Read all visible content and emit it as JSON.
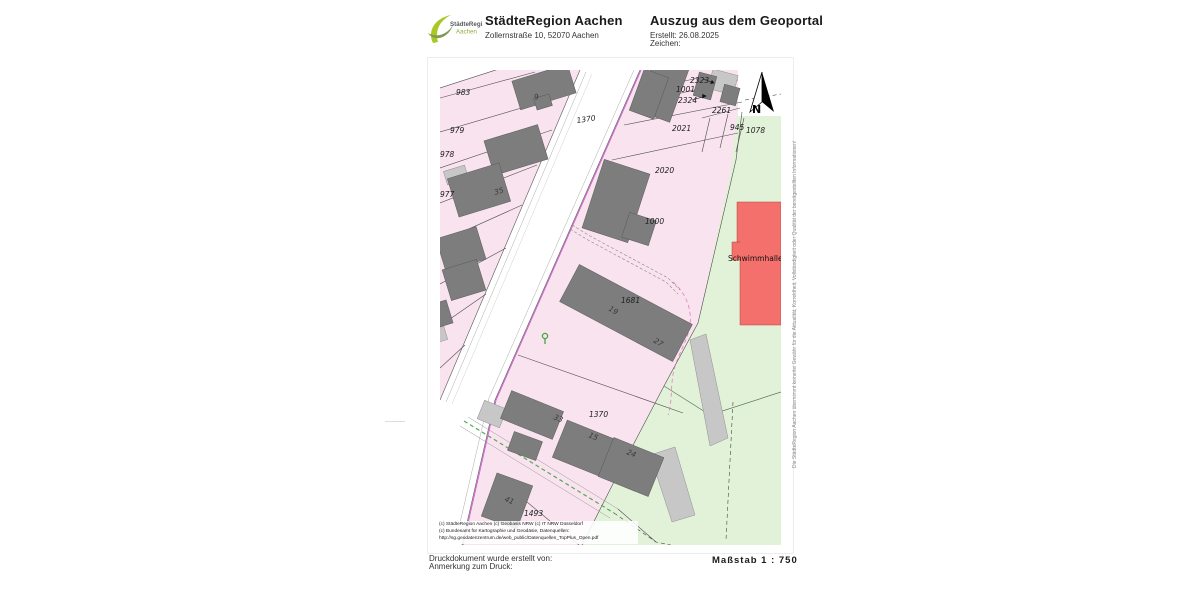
{
  "header": {
    "logo": {
      "line1": "StädteRegion",
      "line2": "Aachen"
    },
    "org_name": "StädteRegion Aachen",
    "org_address": "Zollernstraße 10, 52070 Aachen",
    "doc_title": "Auszug aus dem Geoportal",
    "created_label": "Erstellt: 26.08.2025",
    "reference_label": "Zeichen:"
  },
  "map": {
    "north_label": "N",
    "labels": [
      {
        "t": "983",
        "x": 16,
        "y": 25
      },
      {
        "t": "979",
        "x": 10,
        "y": 63
      },
      {
        "t": "978",
        "x": 0,
        "y": 87
      },
      {
        "t": "977",
        "x": 0,
        "y": 127
      },
      {
        "t": "1370",
        "x": 137,
        "y": 53,
        "r": -8
      },
      {
        "t": "2323",
        "x": 250,
        "y": 13
      },
      {
        "t": "1001",
        "x": 236,
        "y": 22
      },
      {
        "t": "2324",
        "x": 238,
        "y": 33
      },
      {
        "t": "2261",
        "x": 272,
        "y": 43
      },
      {
        "t": "2021",
        "x": 232,
        "y": 61
      },
      {
        "t": "945",
        "x": 290,
        "y": 60
      },
      {
        "t": "1078",
        "x": 306,
        "y": 63
      },
      {
        "t": "2020",
        "x": 215,
        "y": 103
      },
      {
        "t": "1000",
        "x": 205,
        "y": 154
      },
      {
        "t": "1681",
        "x": 181,
        "y": 233
      },
      {
        "t": "1370",
        "x": 149,
        "y": 347
      },
      {
        "t": "1493",
        "x": 84,
        "y": 446
      },
      {
        "t": "Schwimmhalle S",
        "x": 288,
        "y": 191,
        "k": "building",
        "s": 4.6
      },
      {
        "t": "9",
        "x": 95,
        "y": 30,
        "r": -17,
        "k": "house",
        "s": 4
      },
      {
        "t": "35",
        "x": 55,
        "y": 125,
        "r": -17,
        "k": "house",
        "s": 4
      },
      {
        "t": "19",
        "x": 168,
        "y": 240,
        "r": 31,
        "k": "house",
        "s": 4
      },
      {
        "t": "27",
        "x": 213,
        "y": 272,
        "r": 31,
        "k": "house",
        "s": 4
      },
      {
        "t": "33",
        "x": 113,
        "y": 349,
        "r": 22,
        "k": "house",
        "s": 4
      },
      {
        "t": "15",
        "x": 148,
        "y": 367,
        "r": 22,
        "k": "house",
        "s": 4
      },
      {
        "t": "24",
        "x": 186,
        "y": 384,
        "r": 22,
        "k": "house",
        "s": 4
      },
      {
        "t": "41",
        "x": 64,
        "y": 431,
        "r": 22,
        "k": "house",
        "s": 4
      }
    ],
    "copyright_lines": [
      "(c) StädteRegion Aachen   (c) Geobasis NRW   (c) IT NRW Düsseldorf",
      "(c) Bundesamt für Kartographie und Geodäsie, Datenquellen:",
      "http://sg.geodatenzentrum.de/web_public/Datenquellen_TopPlus_Open.pdf"
    ],
    "disclaimer_vertical": "Die StädteRegion Aachen übernimmt keinerlei Gewähr für die Aktualität, Korrektheit, Vollständigkeit oder Qualität der bereitgestellten Informationen!",
    "colors": {
      "parcel_pink": "#f8e3ef",
      "green_area": "#e2f2d9",
      "building_dark": "#7d7d7d",
      "building_light": "#c7c7c7",
      "building_red": "#f3706c",
      "boundary_magenta": "#cf64cf",
      "marker_green": "#41a83e"
    }
  },
  "footer": {
    "created_by_label": "Druckdokument wurde erstellt von:",
    "print_note_label": "Anmerkung zum Druck:",
    "scale_label": "Maßstab 1 : 750"
  }
}
